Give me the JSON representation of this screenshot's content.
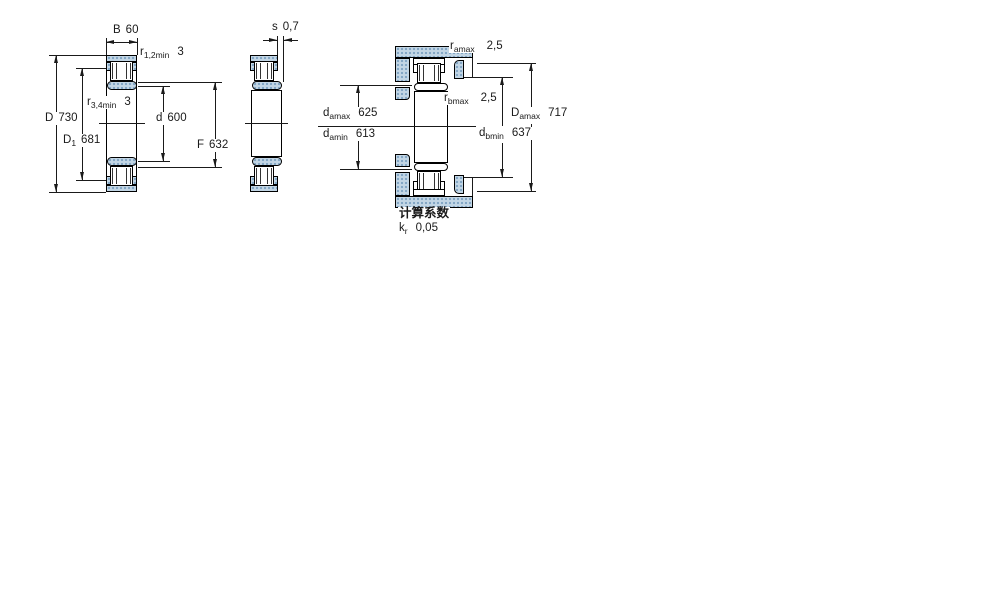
{
  "colors": {
    "hatch_base": "#c2d6e5",
    "hatch_dot": "#84a7c5",
    "line": "#1a1a1a"
  },
  "fig1": {
    "dims": {
      "B": {
        "label": "B",
        "value": "60"
      },
      "r12": {
        "base": "r",
        "sub": "1,2min",
        "value": "3"
      },
      "r34": {
        "base": "r",
        "sub": "3,4min",
        "value": "3"
      },
      "D": {
        "label": "D",
        "value": "730"
      },
      "D1": {
        "base": "D",
        "sub": "1",
        "value": "681"
      },
      "d": {
        "label": "d",
        "value": "600"
      },
      "F": {
        "label": "F",
        "value": "632"
      }
    }
  },
  "fig2": {
    "dims": {
      "s": {
        "label": "s",
        "value": "0,7"
      }
    }
  },
  "fig3": {
    "dims": {
      "ramax": {
        "base": "r",
        "sub": "amax",
        "value": "2,5"
      },
      "rbmax": {
        "base": "r",
        "sub": "bmax",
        "value": "2,5"
      },
      "damax": {
        "base": "d",
        "sub": "amax",
        "value": "625"
      },
      "damin": {
        "base": "d",
        "sub": "amin",
        "value": "613"
      },
      "Damax": {
        "base": "D",
        "sub": "amax",
        "value": "717"
      },
      "dbmin": {
        "base": "d",
        "sub": "bmin",
        "value": "637"
      }
    }
  },
  "footer": {
    "title": "计算系数",
    "kr": {
      "base": "k",
      "sub": "r",
      "value": "0,05"
    }
  }
}
